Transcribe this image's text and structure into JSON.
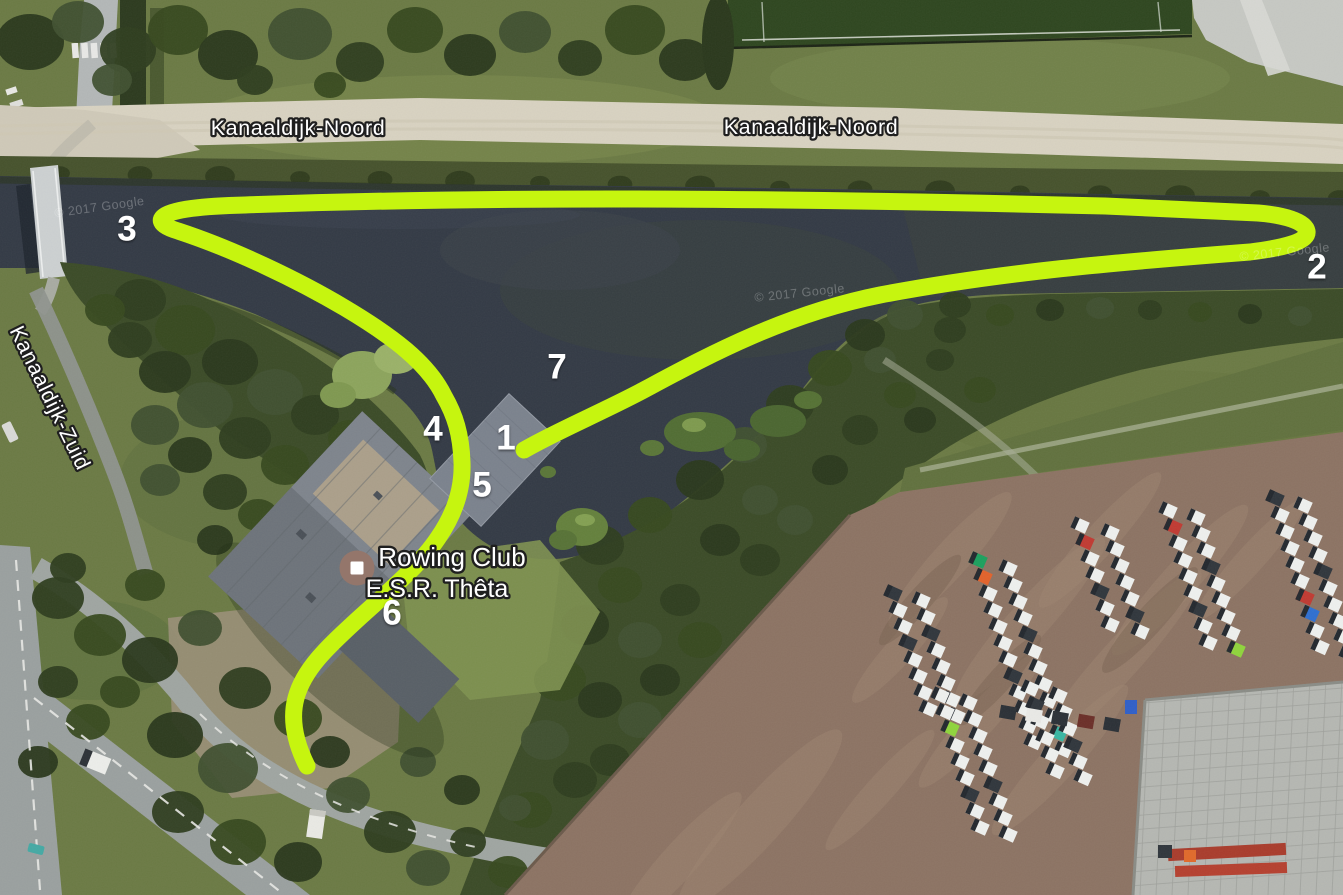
{
  "map_type": "satellite",
  "attribution": "© 2017 Google",
  "route": {
    "color": "#c6f50f",
    "stroke_width": 17
  },
  "street_labels": [
    {
      "text": "Kanaaldijk-Noord",
      "x": 298,
      "y": 128,
      "rotation": 0
    },
    {
      "text": "Kanaaldijk-Noord",
      "x": 811,
      "y": 127,
      "rotation": 0
    },
    {
      "text": "Kanaaldijk-Zuid",
      "x": 50,
      "y": 398,
      "rotation": 64
    }
  ],
  "poi": {
    "name_line1": "Rowing Club",
    "name_line2": "E.S.R. Thêta",
    "label_line1_pos": {
      "x": 452,
      "y": 557
    },
    "label_line2_pos": {
      "x": 437,
      "y": 589
    },
    "marker_pos": {
      "x": 357,
      "y": 568
    },
    "marker_color": "#94766b"
  },
  "waypoints": [
    {
      "label": "1",
      "x": 506,
      "y": 438
    },
    {
      "label": "2",
      "x": 1317,
      "y": 267
    },
    {
      "label": "3",
      "x": 127,
      "y": 229
    },
    {
      "label": "4",
      "x": 433,
      "y": 429
    },
    {
      "label": "5",
      "x": 482,
      "y": 485
    },
    {
      "label": "6",
      "x": 392,
      "y": 613
    },
    {
      "label": "7",
      "x": 557,
      "y": 367
    }
  ],
  "watermarks": [
    {
      "text": "© 2017 Google",
      "x": 100,
      "y": 211,
      "rotation": -8
    },
    {
      "text": "© 2017 Google",
      "x": 800,
      "y": 297,
      "rotation": -6
    },
    {
      "text": "© 2017 Google",
      "x": 1285,
      "y": 256,
      "rotation": -6
    }
  ],
  "colors": {
    "water": "#333a45",
    "grass": "#6b7a44",
    "forest": "#3b4b27",
    "dirt_lot": "#8c7363",
    "gravel_road": "#d8d2c1",
    "asphalt": "#9aa09f",
    "building_roof": "#6d737a",
    "concrete_pad": "#b5b7b2"
  }
}
